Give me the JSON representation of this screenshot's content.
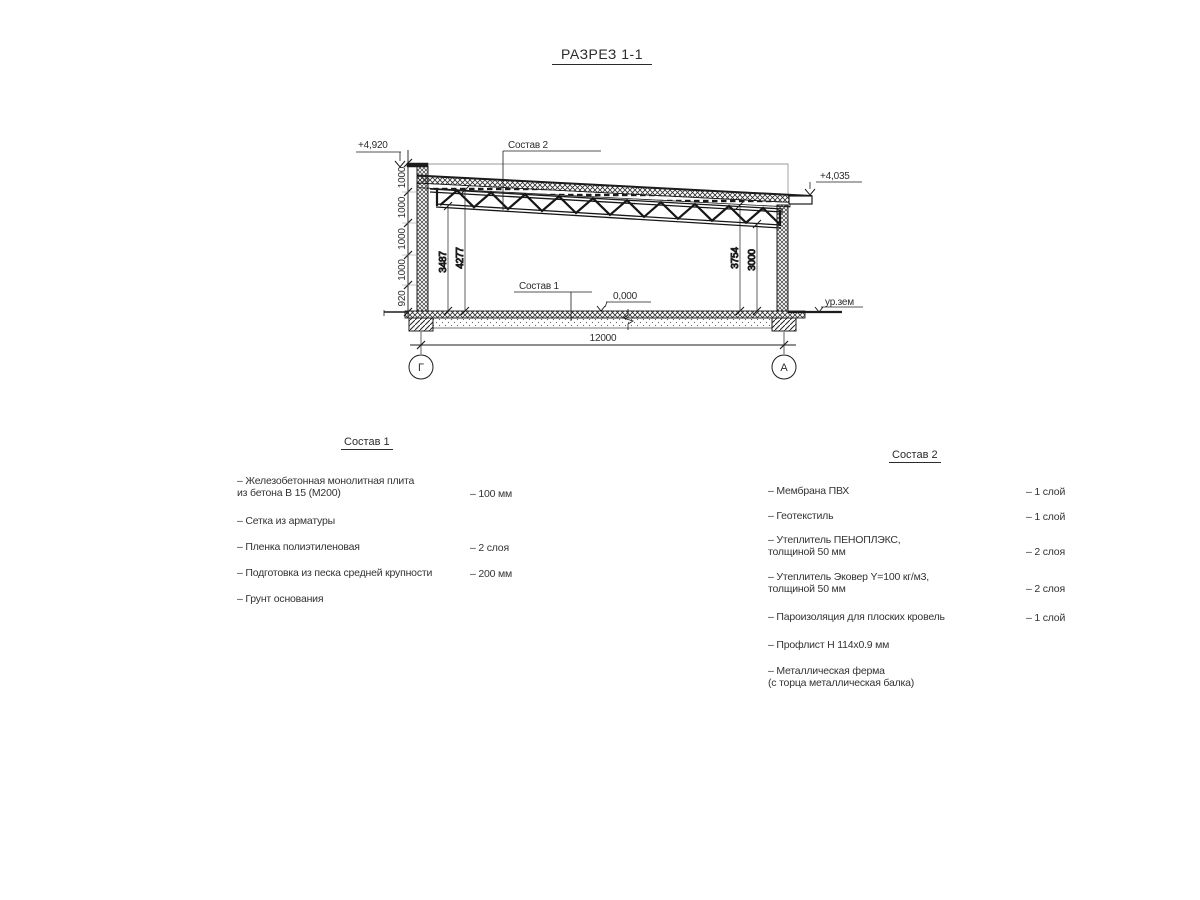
{
  "title": "РАЗРЕЗ 1-1",
  "section": {
    "callout_roof": "Состав 2",
    "callout_floor": "Состав 1",
    "elev_parapet": "+4,920",
    "elev_eave": "+4,035",
    "elev_zero": "0,000",
    "ground_label": "ур.зем",
    "span_dim": "12000",
    "axis_left": "Г",
    "axis_right": "А",
    "chain": [
      "1000",
      "1000",
      "1000",
      "1000",
      "920"
    ],
    "inner_dims": {
      "left_low": "3487",
      "left_high": "4277",
      "right_high": "3754",
      "right_low": "3000"
    }
  },
  "list1": {
    "heading": "Состав 1",
    "items": [
      {
        "label": "– Железобетонная  монолитная плита\nиз бетона В 15 (М200)",
        "value": "– 100 мм"
      },
      {
        "label": "– Сетка из арматуры",
        "value": ""
      },
      {
        "label": "– Пленка полиэтиленовая",
        "value": "– 2 слоя"
      },
      {
        "label": "– Подготовка из песка средней крупности",
        "value": "– 200 мм"
      },
      {
        "label": "– Грунт основания",
        "value": ""
      }
    ]
  },
  "list2": {
    "heading": "Состав 2",
    "items": [
      {
        "label": "– Мембрана ПВХ",
        "value": "– 1 слой"
      },
      {
        "label": "– Геотекстиль",
        "value": "– 1 слой"
      },
      {
        "label": "– Утеплитель ПЕНОПЛЭКС,\nтолщиной 50 мм",
        "value": "– 2 слоя"
      },
      {
        "label": "– Утеплитель Эковер Y=100 кг/м3,\nтолщиной 50 мм",
        "value": "– 2 слоя"
      },
      {
        "label": "– Пароизоляция для плоских кровель",
        "value": "– 1 слой"
      },
      {
        "label": "– Профлист Н 114х0.9 мм",
        "value": ""
      },
      {
        "label": "– Металлическая ферма\n(с торца металлическая балка)",
        "value": ""
      }
    ]
  }
}
